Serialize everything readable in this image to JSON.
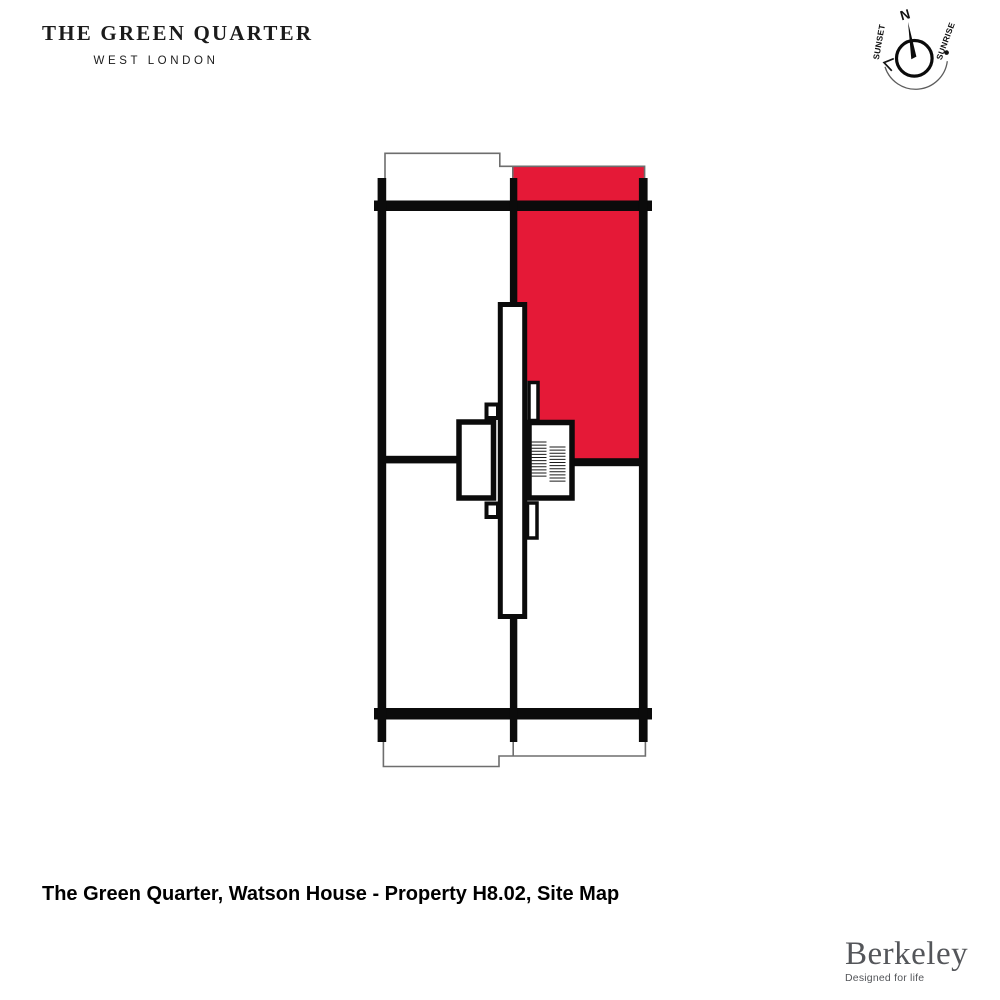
{
  "brand": {
    "title": "THE GREEN QUARTER",
    "subtitle": "WEST LONDON"
  },
  "compass": {
    "north": "N",
    "sunset": "SUNSET",
    "sunrise": "SUNRISE"
  },
  "plan": {
    "highlighted_property": "H8.02",
    "highlight_color": "#E51937",
    "wall_color": "#0B0B0B",
    "outline_color": "#6E6E6E"
  },
  "caption": {
    "text": "The Green Quarter, Watson House - Property H8.02, Site Map"
  },
  "footer": {
    "logo": "Berkeley",
    "tagline": "Designed for life"
  }
}
